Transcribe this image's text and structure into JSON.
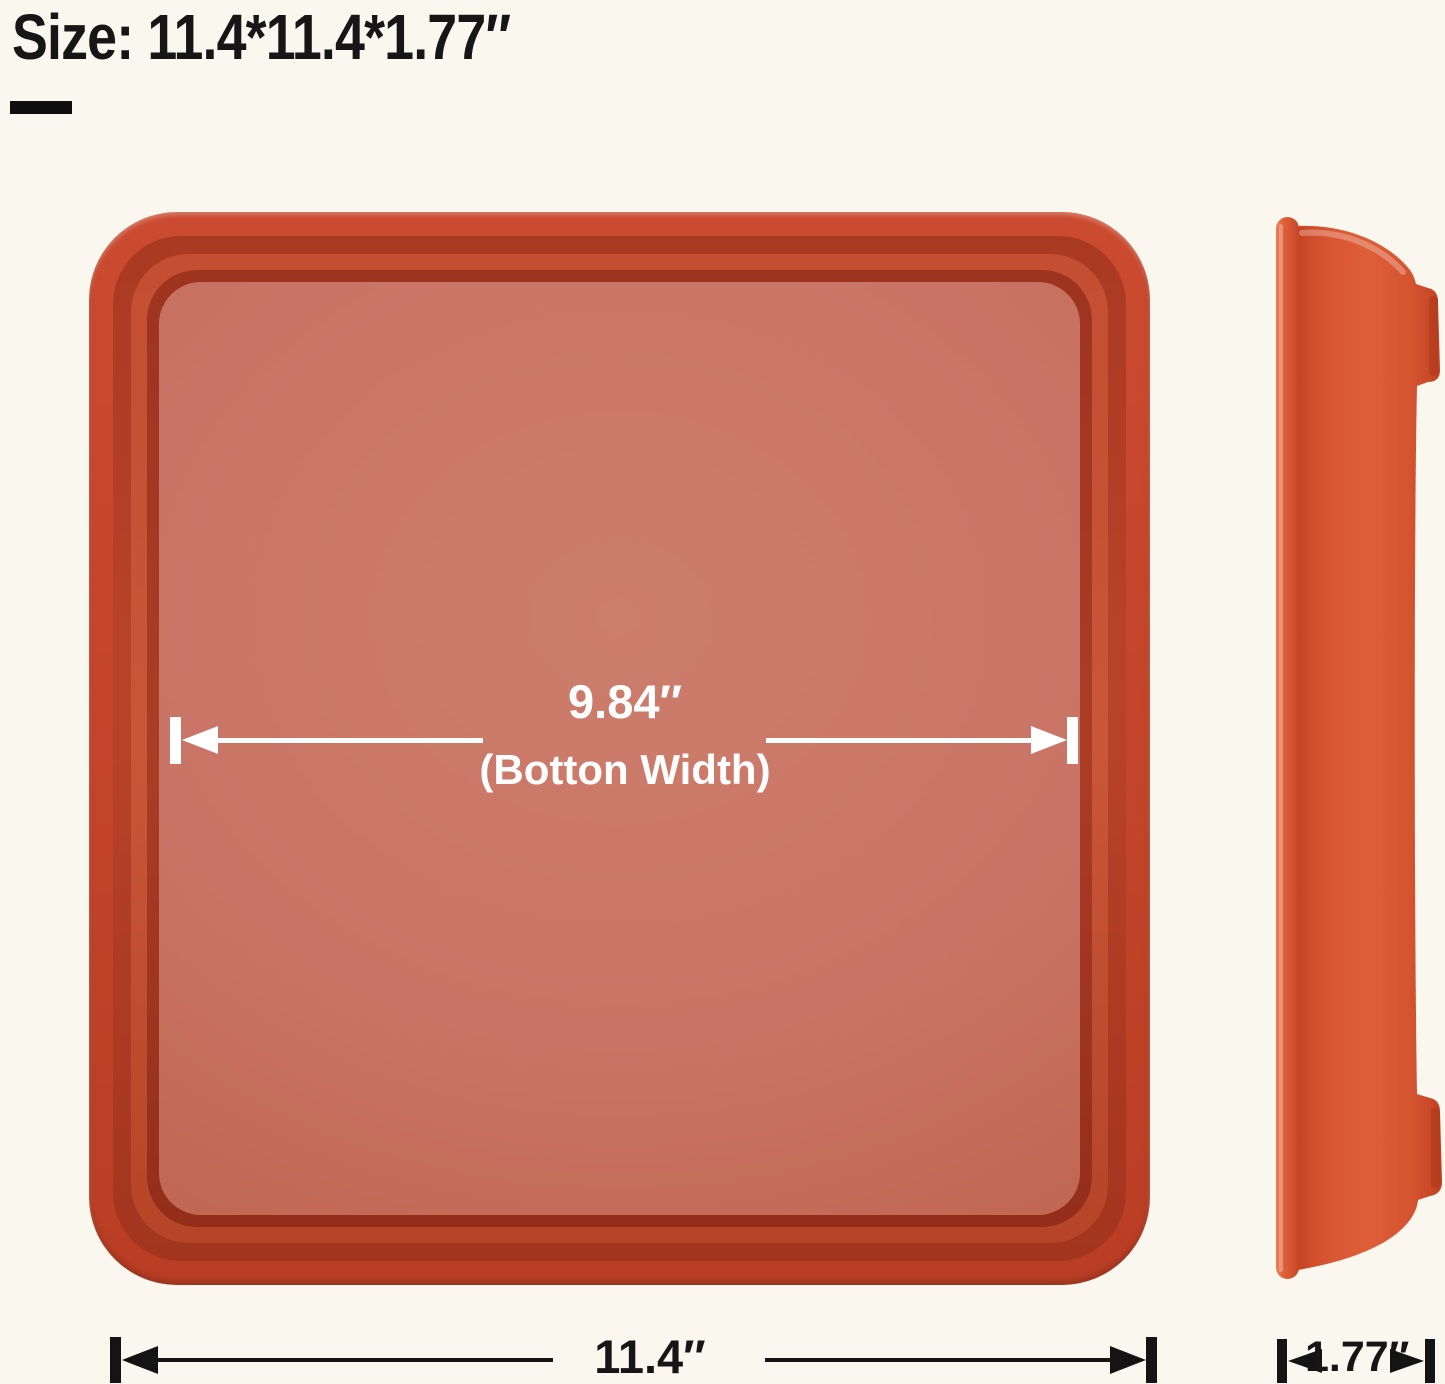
{
  "background": "#faf7ef",
  "title": {
    "text": "Size: 11.4*11.4*1.77″"
  },
  "top_view": {
    "description": "square plant saucer seen from above",
    "inner_width_value": "9.84″",
    "inner_width_label": "(Botton Width)",
    "outer_width_value": "11.4″"
  },
  "side_view": {
    "description": "saucer side profile",
    "depth_value": "1.77″"
  },
  "colors": {
    "background": "#faf7ef",
    "tray_rim": "#c8462a",
    "tray_wall_dark": "#a2351e",
    "tray_floor": "#c97466",
    "side_body": "#d8552f",
    "dimension_light": "#ffffff",
    "dimension_dark": "#141414",
    "title_text": "#161616"
  }
}
